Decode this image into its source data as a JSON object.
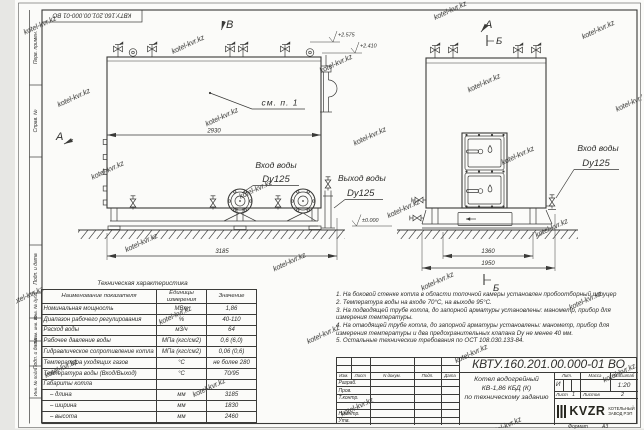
{
  "meta": {
    "background": "#e7e7e4",
    "sheet": "#fbfbf9",
    "line_color": "#3a3a38",
    "watermark": "kotel-kvr.kz"
  },
  "frame": {
    "stamp_number": "КВТУ.160.201.00.000-01 ВО",
    "side_labels": [
      "Перв. примен.",
      "Справ. №",
      "Подп. и дата",
      "Инв. № дубл.",
      "Взам. инв. №",
      "Подп. и дата",
      "Инв. № подл."
    ],
    "format_label": "Формат",
    "format_value": "А3"
  },
  "drawing": {
    "view_b": "В",
    "view_a": "А",
    "section_b": "Б",
    "elev_1": "+2.575",
    "elev_2": "+2.410",
    "elev_zero": "±0.000",
    "see_note": "см. п. 1",
    "dim_body": "2930",
    "dim_overall": "3185",
    "dim_base_inner": "1360",
    "dim_base_outer": "1950",
    "inlet_label": "Вход воды",
    "outlet_label": "Выход воды",
    "dn_label": "Dy125"
  },
  "tech_table": {
    "title": "Техническая характеристика",
    "headers": [
      "Наименование показателя",
      "Единицы измерения",
      "Значение"
    ],
    "rows": [
      {
        "name": "Номинальная мощность",
        "unit": "МВт",
        "value": "1,86"
      },
      {
        "name": "Диапазон рабочего регулирования",
        "unit": "%",
        "value": "40-110"
      },
      {
        "name": "Расход воды",
        "unit": "м3/ч",
        "value": "64"
      },
      {
        "name": "Рабочее давление воды",
        "unit": "МПа (кгс/см2)",
        "value": "0,6 (6,0)"
      },
      {
        "name": "Гидравлическое сопротивление котла",
        "unit": "МПа (кгс/см2)",
        "value": "0,06 (0,6)"
      },
      {
        "name": "Температура уходящих газов",
        "unit": "°С",
        "value": "не более 280"
      },
      {
        "name": "Температура воды (Вход/Выход)",
        "unit": "°С",
        "value": "70/95"
      },
      {
        "name": "Габариты котла",
        "unit": "",
        "value": ""
      },
      {
        "name": "– длина",
        "unit": "мм",
        "value": "3185"
      },
      {
        "name": "– ширина",
        "unit": "мм",
        "value": "1830"
      },
      {
        "name": "– высота",
        "unit": "мм",
        "value": "2460"
      }
    ]
  },
  "notes": {
    "items": [
      "1.  На боковой стенке котла в области топочной камеры установлен пробоотборный штуцер",
      "2.  Температура воды на входе 70°С, на выходе 95°С.",
      "3.  На подводящей трубе котла, до запорной арматуры установлены: манометр, прибор для измерения температуры.",
      "4.  На отводящей трубе котла, до запорной арматуры установлены: манометр, прибор для измерения температуры и два предохранительных клапана Dу не менее 40 мм.",
      "5.  Остальные технические требования по ОСТ 108.030.133-84."
    ]
  },
  "title_block": {
    "doc_number": "КВТУ.160.201.00.000-01 ВО",
    "col_headers": [
      "Изм.",
      "Лист",
      "N докум.",
      "Подп.",
      "Дата"
    ],
    "row_labels": [
      "Разраб.",
      "Пров.",
      "Т.контр.",
      "",
      "Н.контр.",
      "Утв."
    ],
    "product_title_1": "Котел водогрейный",
    "product_title_2": "КВ-1,86 КБД (К)",
    "product_title_3": "по техническому заданию",
    "lit_label": "Лит.",
    "mass_label": "Масса",
    "scale_label": "Масштаб",
    "lit_value": "И",
    "scale_value": "1:20",
    "sheet_label": "Лист",
    "sheet_value": "1",
    "sheets_label": "Листов",
    "sheets_value": "2",
    "logo_text": "KVZR",
    "logo_sub_1": "КОТЕЛЬНЫЙ",
    "logo_sub_2": "ЗАВОД РЭП"
  }
}
